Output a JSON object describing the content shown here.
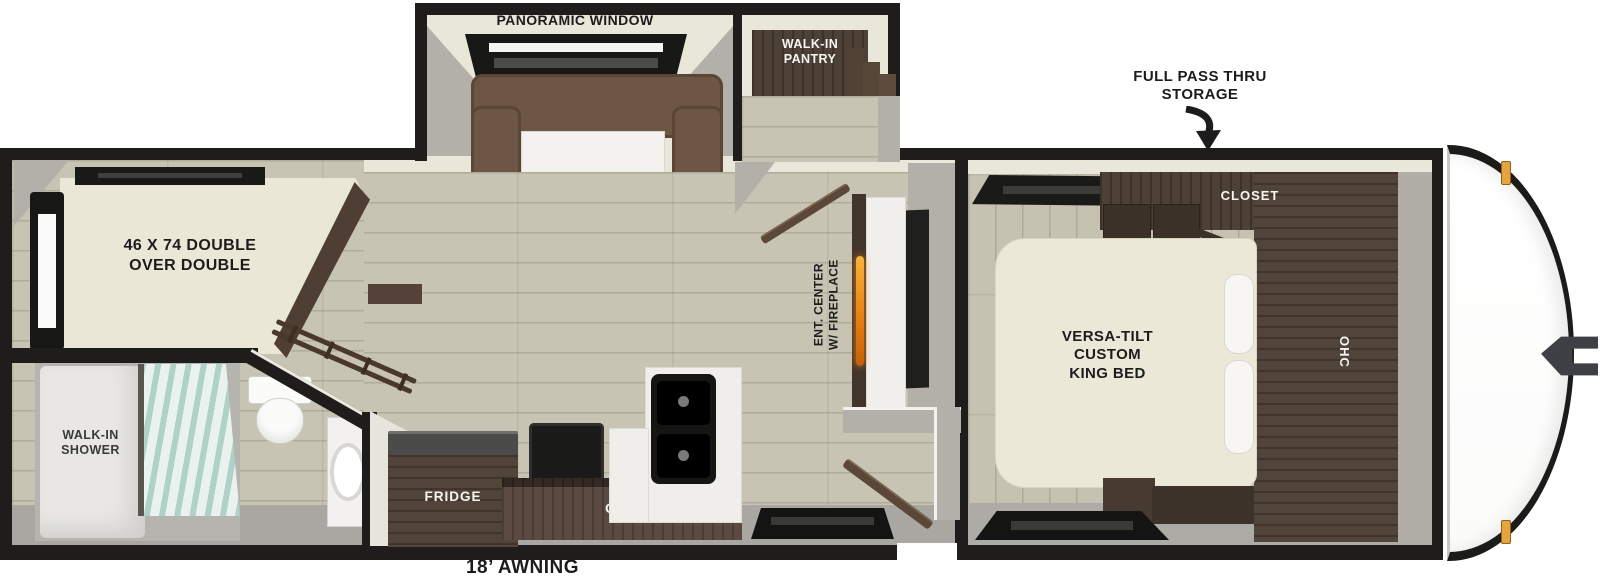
{
  "floorplan": {
    "type": "travel-trailer-floorplan",
    "labels": {
      "panoramic_window": "PANORAMIC WINDOW",
      "walk_in_pantry": "WALK-IN\nPANTRY",
      "full_pass_thru_storage": "FULL PASS THRU\nSTORAGE",
      "closet": "CLOSET",
      "king_bed": "VERSA-TILT\nCUSTOM\nKING BED",
      "bedroom_ohc": "OHC",
      "bunk_bed": "46 X 74 DOUBLE\nOVER DOUBLE",
      "ent_center": "ENT. CENTER\nW/ FIREPLACE",
      "walk_in_shower": "WALK-IN\nSHOWER",
      "fridge": "FRIDGE",
      "kitchen_ohc": "OHC",
      "awning": "18’ AWNING"
    },
    "icons": {
      "storage_arrow": "curved-down-arrow"
    },
    "colors": {
      "wall": "#1e1d1b",
      "interior_wall": "#e9e6da",
      "wall_gray": "#b3b0a9",
      "wood_floor": "#c8c4b3",
      "cabinet_wood": "#473a30",
      "sofa": "#6d5645",
      "mattress": "#ece8d8",
      "shower_glass": "#d9ece6",
      "fireplace_flame": "#ef8f1c",
      "marker_light": "#e7a43c",
      "label_text": "#1c1c1c"
    }
  }
}
